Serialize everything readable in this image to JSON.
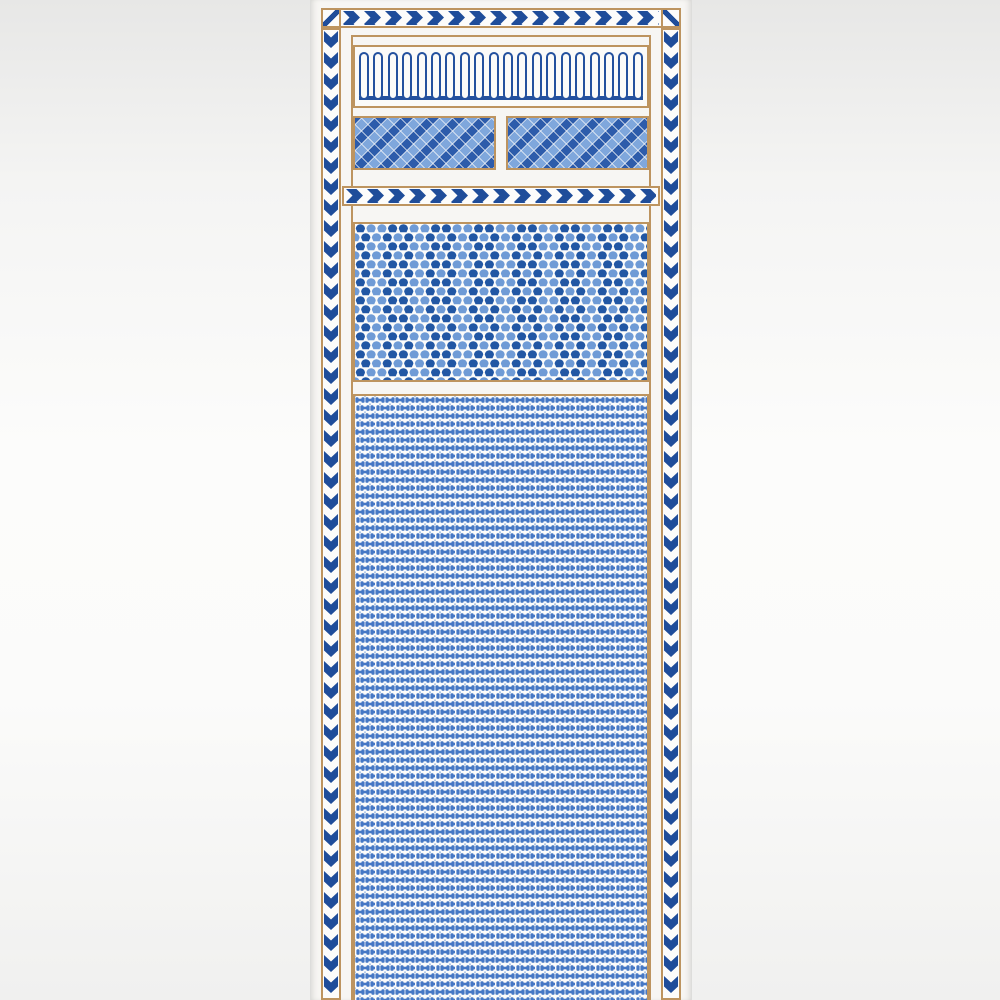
{
  "artwork": {
    "title": "Blue and white geometric wallpaper panel",
    "colors": {
      "navy": "#1f4d9a",
      "capsule_blue": "#24519e",
      "tan": "#bd945f",
      "diamond_dark": "#2d5cab",
      "diamond_light": "#7fa7dc",
      "fan_dark": "#2257a4",
      "fan_light": "#6f9bd6",
      "bone_blue": "#4678c5",
      "bone_light": "#9dbbe4",
      "panel_white": "#f7f6f3",
      "pattern_white": "#fcfcfb"
    },
    "borders": {
      "top_band_direction": "right",
      "left_band_direction": "down",
      "right_band_direction": "down",
      "divider_direction": "right",
      "style": "blue and white chevron ribbon with tan edge rules"
    },
    "sections": [
      {
        "name": "arcade-frieze",
        "motif": "vertical capsule arches on blue base line",
        "count": 20
      },
      {
        "name": "diamond-check-left",
        "motif": "diagonal diamond checker in two blues"
      },
      {
        "name": "diamond-check-right",
        "motif": "diagonal diamond checker in two blues"
      },
      {
        "name": "chevron-divider",
        "motif": "right-pointing chevron band"
      },
      {
        "name": "fan-field",
        "motif": "offset rows of scallop fans in two blues"
      },
      {
        "name": "bone-field",
        "motif": "dense offset grid of blue dumbbell dots"
      }
    ]
  }
}
